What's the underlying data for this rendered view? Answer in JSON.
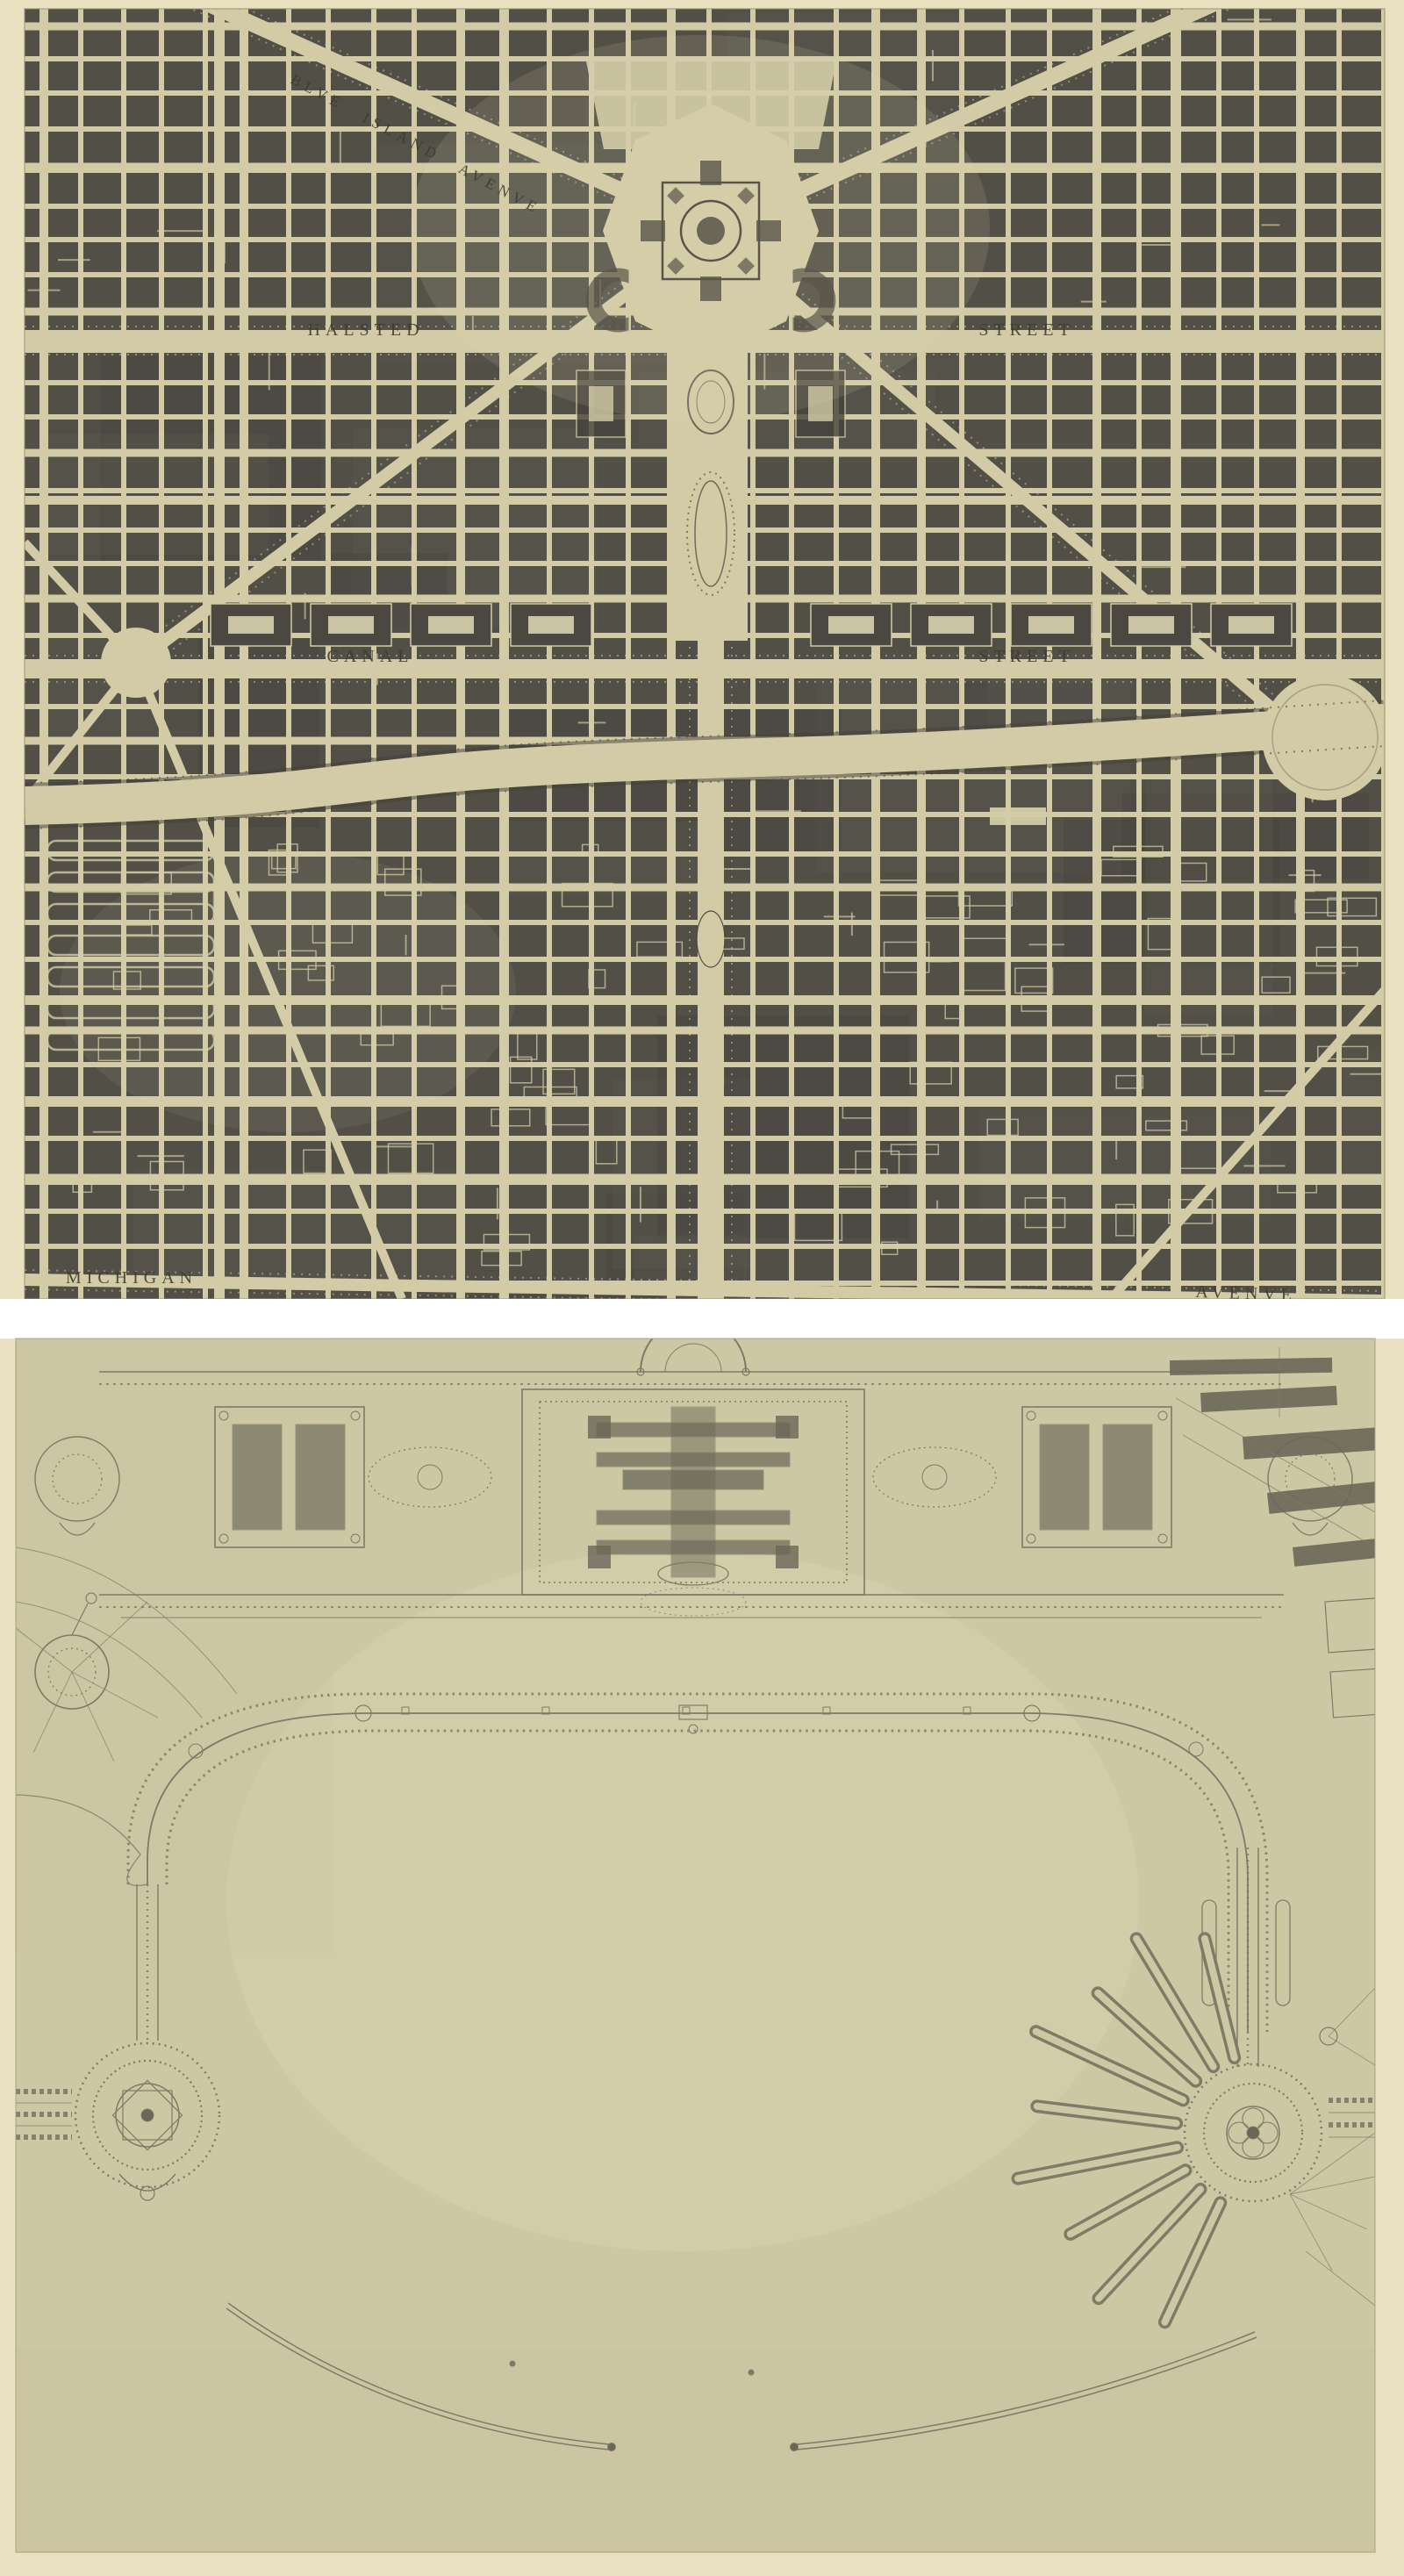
{
  "page": {
    "background": "#e9e1bf",
    "separator_color": "#ffffff"
  },
  "top_plate": {
    "description": "street grid plan with diagonal avenues converging on a domed civic center",
    "colors": {
      "paper": "#d2cba6",
      "blocks": "#524f47",
      "blocks_dark": "#45423b",
      "ink": "#3e3a2f",
      "court": "#d8d2ae"
    },
    "labels": {
      "blue_island": "BLVE ISLAND AVENVE",
      "halsted": "HALSTED",
      "halsted_street": "STREET",
      "canal": "CANAL",
      "canal_street": "STREET",
      "michigan": "MICHIGAN",
      "michigan_avenue": "AVENVE"
    }
  },
  "bottom_plate": {
    "description": "lakefront park and yacht harbor plan with museum group, promenades, radial piers and breakwater",
    "colors": {
      "paper": "#cdc8a4",
      "line": "#7e7b66",
      "line_soft": "#96927c",
      "dark": "#6a6757"
    },
    "labels": {}
  }
}
